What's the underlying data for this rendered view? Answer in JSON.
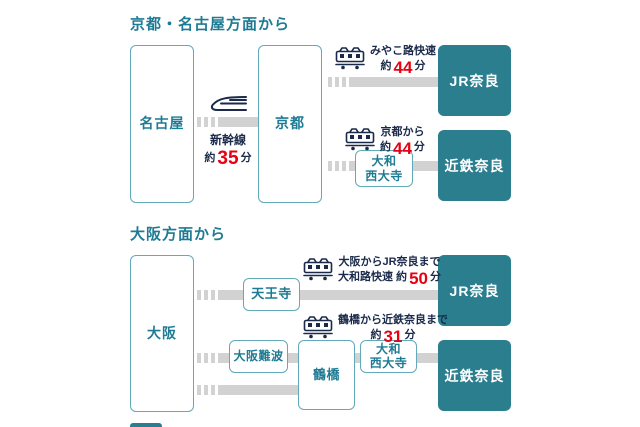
{
  "colors": {
    "teal_text": "#1e7b93",
    "teal_box": "#2b7e8e",
    "box_border": "#62a9ba",
    "track_gray": "#d2d2d2",
    "navy_text": "#1b2a4a",
    "time_red": "#e60012"
  },
  "icons": {
    "shinkansen": "shinkansen-icon",
    "local_train": "train-icon"
  },
  "section1": {
    "title": "京都・名古屋方面から",
    "stations": {
      "nagoya": "名古屋",
      "kyoto": "京都",
      "jr_nara": "JR奈良",
      "kintetsu_nara": "近鉄奈良",
      "yamato_saidaiji_line1": "大和",
      "yamato_saidaiji_line2": "西大寺"
    },
    "shinkansen_route": {
      "line": "新幹線",
      "approx": "約",
      "minutes": "35",
      "unit": "分"
    },
    "route_jr": {
      "line1": "みやこ路快速",
      "approx": "約",
      "minutes": "44",
      "unit": "分"
    },
    "route_kintetsu": {
      "line1": "京都から",
      "approx": "約",
      "minutes": "44",
      "unit": "分"
    }
  },
  "section2": {
    "title": "大阪方面から",
    "stations": {
      "osaka": "大阪",
      "tennoji": "天王寺",
      "osaka_namba": "大阪難波",
      "tsuruhashi": "鶴橋",
      "yamato_saidaiji_line1": "大和",
      "yamato_saidaiji_line2": "西大寺",
      "jr_nara": "JR奈良",
      "kintetsu_nara": "近鉄奈良"
    },
    "route_jr": {
      "line1": "大阪からJR奈良まで",
      "line2_prefix": "大和路快速 約",
      "minutes": "50",
      "unit": "分"
    },
    "route_kintetsu": {
      "line1": "鶴橋から近鉄奈良まで",
      "approx": "約",
      "minutes": "31",
      "unit": "分"
    }
  }
}
